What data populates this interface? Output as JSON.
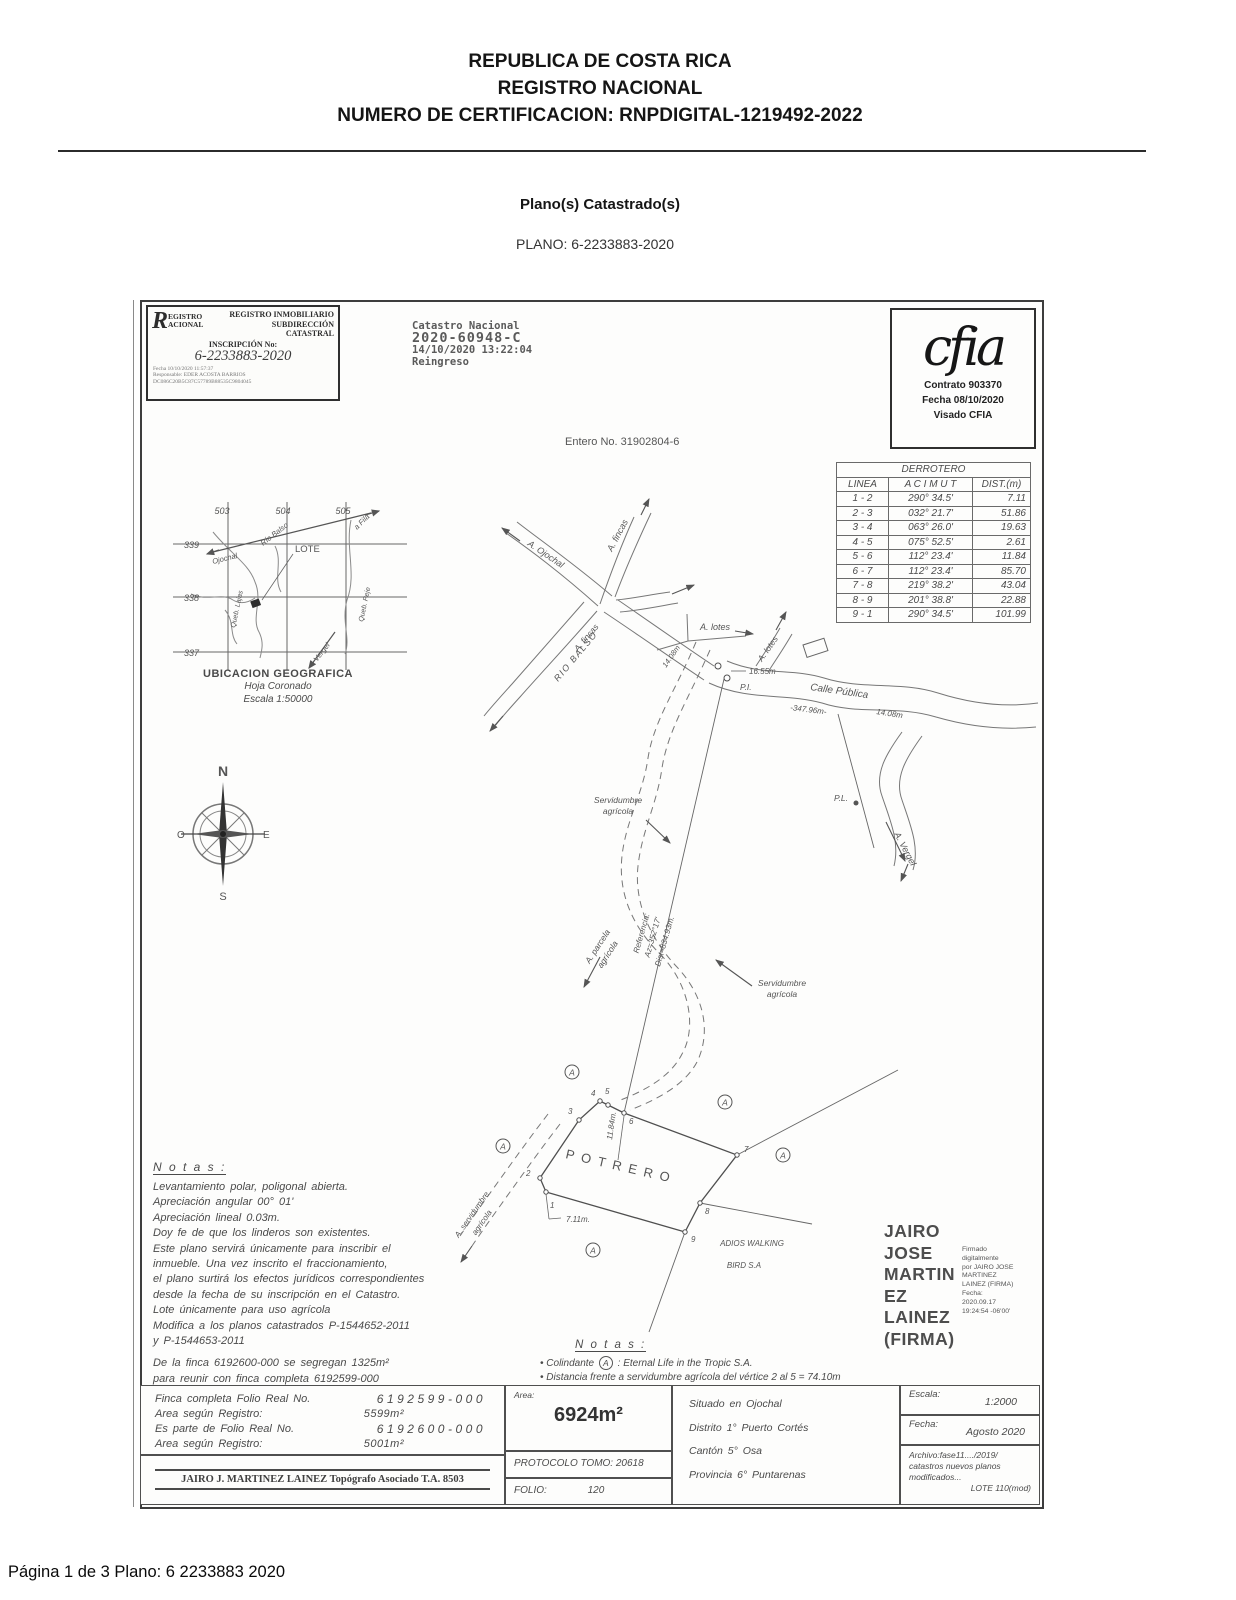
{
  "header": {
    "line1": "REPUBLICA DE COSTA RICA",
    "line2": "REGISTRO NACIONAL",
    "line3": "NUMERO DE CERTIFICACION: RNPDIGITAL-1219492-2022",
    "section_title": "Plano(s) Catastrado(s)",
    "plano": "PLANO: 6-2233883-2020"
  },
  "stamp": {
    "logo_r": "R",
    "logo1": "EGISTRO",
    "logo2": "ACIONAL",
    "t1": "REGISTRO INMOBILIARIO",
    "t2": "SUBDIRECCIÓN",
    "t3": "CATASTRAL",
    "insc_label": "INSCRIPCIÓN No:",
    "insc_value": "6-2233883-2020",
    "f1": "Fecha      10/10/2020 11:57:37",
    "f2": "Responsable: EDER ACOSTA BARRIOS",
    "f3": "DC086C20B5C87C57789B88535C9804045"
  },
  "catastro": {
    "c1": "Catastro Nacional",
    "c2": "2020-60948-C",
    "c3": "14/10/2020 13:22:04",
    "c4": "Reingreso"
  },
  "cfia": {
    "logo": "cfia",
    "contrato": "Contrato 903370",
    "fecha": "Fecha 08/10/2020",
    "visado": "Visado CFIA"
  },
  "entero": "Entero No. 31902804-6",
  "derrotero": {
    "title": "DERROTERO",
    "headers": [
      "LINEA",
      "A C I M U T",
      "DIST.(m)"
    ],
    "rows": [
      [
        "1 - 2",
        "290° 34.5'",
        "7.11"
      ],
      [
        "2 - 3",
        "032° 21.7'",
        "51.86"
      ],
      [
        "3 - 4",
        "063° 26.0'",
        "19.63"
      ],
      [
        "4 - 5",
        "075° 52.5'",
        "2.61"
      ],
      [
        "5 - 6",
        "112° 23.4'",
        "11.84"
      ],
      [
        "6 - 7",
        "112° 23.4'",
        "85.70"
      ],
      [
        "7 - 8",
        "219° 38.2'",
        "43.04"
      ],
      [
        "8 - 9",
        "201° 38.8'",
        "22.88"
      ],
      [
        "9 - 1",
        "290° 34.5'",
        "101.99"
      ]
    ]
  },
  "location_map": {
    "cols": [
      "503",
      "504",
      "505"
    ],
    "rows": [
      "339",
      "338",
      "337"
    ],
    "lote": "LOTE",
    "rio": "Río Balso",
    "ojochal": "Ojochal",
    "fila": "a Fila",
    "queb_l": "Queb. Lajas",
    "queb_r": "Queb. Peje",
    "vergel": "Vergel",
    "cap1": "UBICACION GEOGRAFICA",
    "cap2": "Hoja Coronado",
    "cap3": "Escala 1:50000"
  },
  "compass": {
    "n": "N",
    "s": "S",
    "e": "E",
    "w": "O"
  },
  "survey": {
    "ojochal": "A. Ojochal",
    "fincas_top": "A. fincas",
    "fincas_left": "A. fincas",
    "rio_balso": "RIO BALSO",
    "lotes_h": "A. lotes",
    "lotes_r": "A. lotes",
    "calle": "Calle Pública",
    "d347": "-347.96m-",
    "d1408a": "14.08m",
    "d1408b": "14.08m",
    "d1655": "16.55m",
    "pi": "P.I.",
    "pl": "P.L.",
    "vergel": "A. Vergel",
    "serv1a": "Servidumbre",
    "serv1b": "agrícola",
    "serv2a": "Servidumbre",
    "serv2b": "agrícola",
    "parcela1": "A. parcela",
    "parcela2": "agrícola",
    "ref1": "Referencia:",
    "ref2": "Az=352°17'",
    "ref3": "Dist=834.93m.",
    "aserv1": "A. servidumbre",
    "aserv2": "agrícola",
    "potrero": "POTRERO",
    "d1184": "11.84m.",
    "d711": "7.11m.",
    "adios1": "ADIOS WALKING",
    "adios2": "BIRD S.A",
    "col_mark": "A",
    "v": [
      "1",
      "2",
      "3",
      "4",
      "5",
      "6",
      "7",
      "8",
      "9"
    ]
  },
  "notes_left": {
    "title": "N o t a s :",
    "lines": [
      "Levantamiento polar, poligonal abierta.",
      "Apreciación angular 00° 01'",
      "Apreciación lineal 0.03m.",
      "Doy fe de que los linderos son existentes.",
      "Este plano servirá únicamente para inscribir el",
      "inmueble. Una vez inscrito el fraccionamiento,",
      "el plano surtirá los efectos jurídicos correspondientes",
      "desde la fecha de su inscripción en el Catastro.",
      "Lote únicamente para uso agrícola",
      "Modifica a los planos catastrados P-1544652-2011",
      "y P-1544653-2011"
    ],
    "lines2": [
      "De la finca 6192600-000 se segregan 1325m²",
      "para reunir con finca completa 6192599-000"
    ]
  },
  "signature": {
    "n1": "JAIRO",
    "n2": "JOSE",
    "n3": "MARTIN",
    "n4": "EZ",
    "n5": "LAINEZ",
    "n6": "(FIRMA)",
    "small": [
      "Firmado",
      "digitalmente",
      "por JAIRO JOSE",
      "MARTINEZ",
      "LAINEZ (FIRMA)",
      "Fecha:",
      "2020.09.17",
      "19:24:54 -06'00'"
    ]
  },
  "notes_center": {
    "title": "N o t a s :",
    "b1_pre": "• Colindante",
    "b1_mark": "A",
    "b1_post": ": Eternal Life in the Tropic S.A.",
    "b2": "• Distancia frente a servidumbre agrícola del vértice 2 al 5  =  74.10m"
  },
  "bottom": {
    "finca_l1": "Finca completa Folio Real No.",
    "finca_v1": "6192599-000",
    "finca_l2": "Area según Registro:",
    "finca_v2": "5599m²",
    "finca_l3": "Es parte de Folio Real No.",
    "finca_v3": "6192600-000",
    "finca_l4": "Area según Registro:",
    "finca_v4": "5001m²",
    "surveyor": "JAIRO J. MARTINEZ LAINEZ Topógrafo Asociado T.A. 8503",
    "area_label": "Area:",
    "area_value": "6924m²",
    "protocolo": "PROTOCOLO TOMO: 20618",
    "folio_label": "FOLIO:",
    "folio_value": "120",
    "loc1": "Situado en Ojochal",
    "loc2": "Distrito 1° Puerto Cortés",
    "loc3": "Cantón 5° Osa",
    "loc4": "Provincia 6° Puntarenas",
    "escala_label": "Escala:",
    "escala_value": "1:2000",
    "fecha_label": "Fecha:",
    "fecha_value": "Agosto 2020",
    "archivo1": "Archivo:fase11..../2019/",
    "archivo2": "catastros nuevos planos",
    "archivo3": "modificados...",
    "archivo4": "LOTE 110(mod)"
  },
  "footer": "Página 1 de 3  Plano: 6 2233883 2020"
}
